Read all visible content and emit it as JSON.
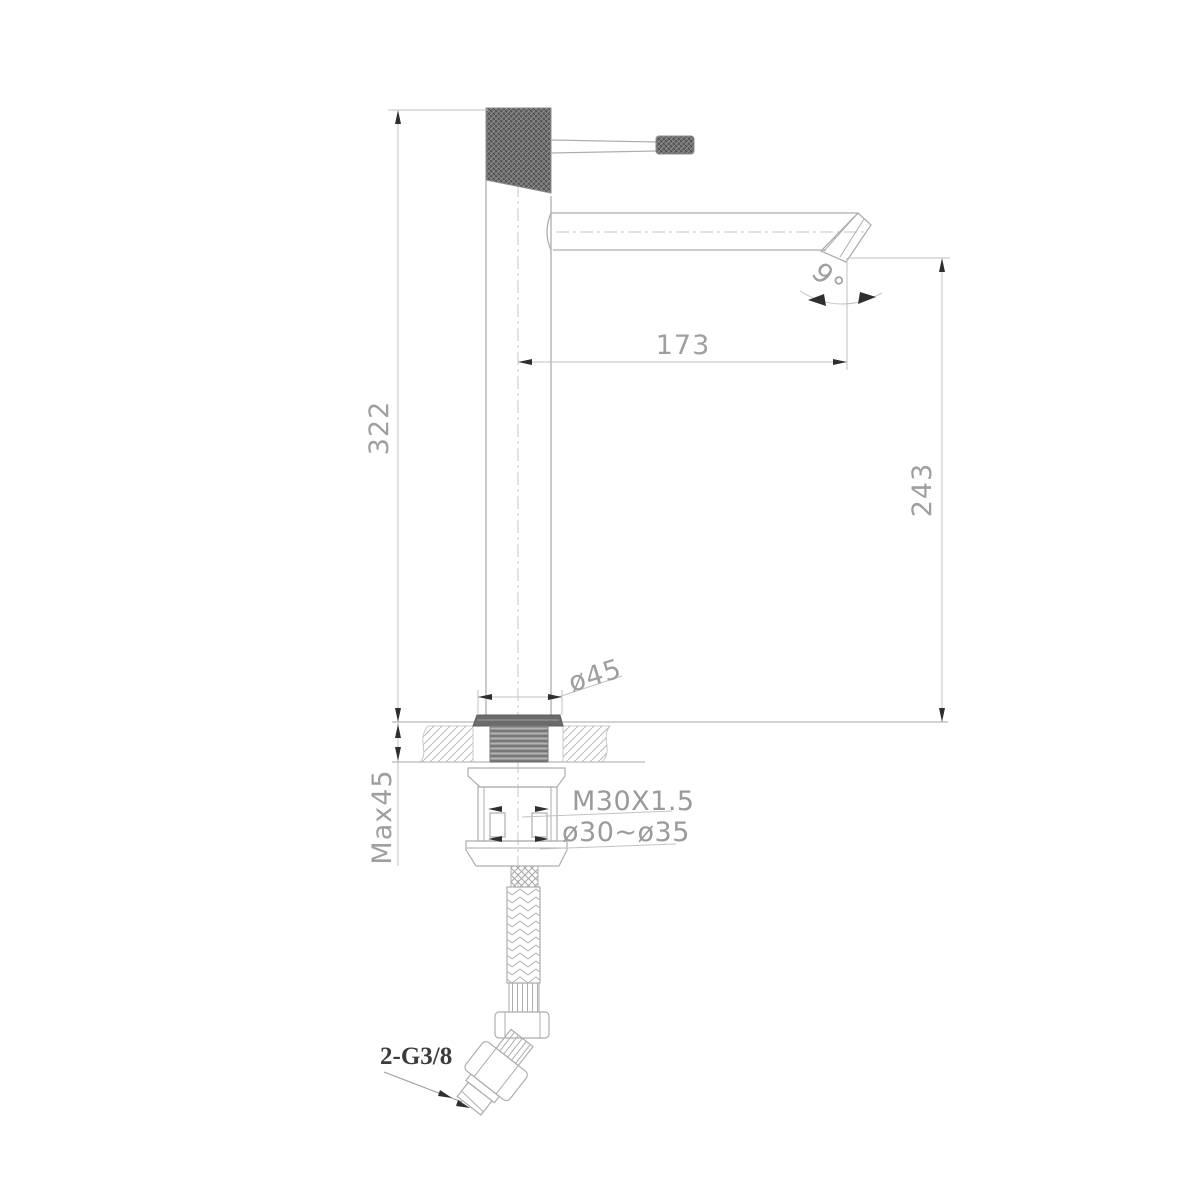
{
  "drawing": {
    "type": "faucet-technical-drawing",
    "background": "#ffffff",
    "colors": {
      "outline": "#aeaeae",
      "dim_line": "#c2c2c2",
      "text": "#9f9f9f",
      "arrow": "#2f2f2f",
      "dark_fill": "#6b6b6b",
      "connector_label": "#3c3c3c"
    },
    "dimensions": {
      "total_height": "322",
      "spout_reach": "173",
      "spout_height": "243",
      "spout_angle": "9°",
      "base_diameter": "ø45",
      "max_deck_thickness": "Max45",
      "mounting_thread": "M30X1.5",
      "hole_diameter_range": "ø30~ø35",
      "hose_connection": "2-G3/8"
    }
  }
}
